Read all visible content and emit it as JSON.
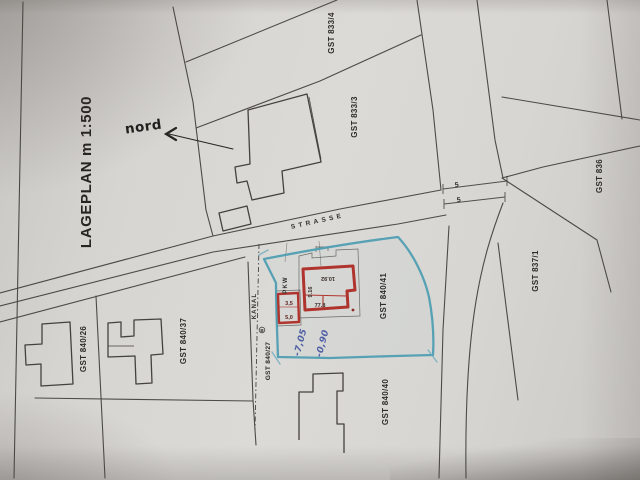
{
  "plan": {
    "title": "LAGEPLAN m 1:500",
    "north_label": "nord",
    "street_label": "STRASSE",
    "sewer_label": "KANAL",
    "parking_label": "PKW",
    "marker_label": "B",
    "parcels": [
      {
        "id": "GST 833/4"
      },
      {
        "id": "GST 833/3"
      },
      {
        "id": "GST 836"
      },
      {
        "id": "GST 837/1"
      },
      {
        "id": "GST 840/41"
      },
      {
        "id": "GST 840/40"
      },
      {
        "id": "GST 840/37"
      },
      {
        "id": "GST 840/26"
      },
      {
        "id": "GST 840/27"
      }
    ],
    "road_width_dims": [
      {
        "value": "5"
      },
      {
        "value": "5"
      }
    ],
    "building_dims": [
      {
        "value": "10.92"
      },
      {
        "value": "9.16"
      },
      {
        "value": "77.8"
      }
    ],
    "garage_dims": [
      {
        "value": "3,5"
      },
      {
        "value": "5,0"
      }
    ],
    "handwritten_marks": [
      {
        "value": "-7,05"
      },
      {
        "value": "-0,90"
      }
    ],
    "colors": {
      "proposed_building": "#b0342e",
      "parcel_highlight": "#4c9db2",
      "handwriting": "#4f5fa5",
      "ink": "#3a3833",
      "paper": "#d8d6d2"
    }
  }
}
